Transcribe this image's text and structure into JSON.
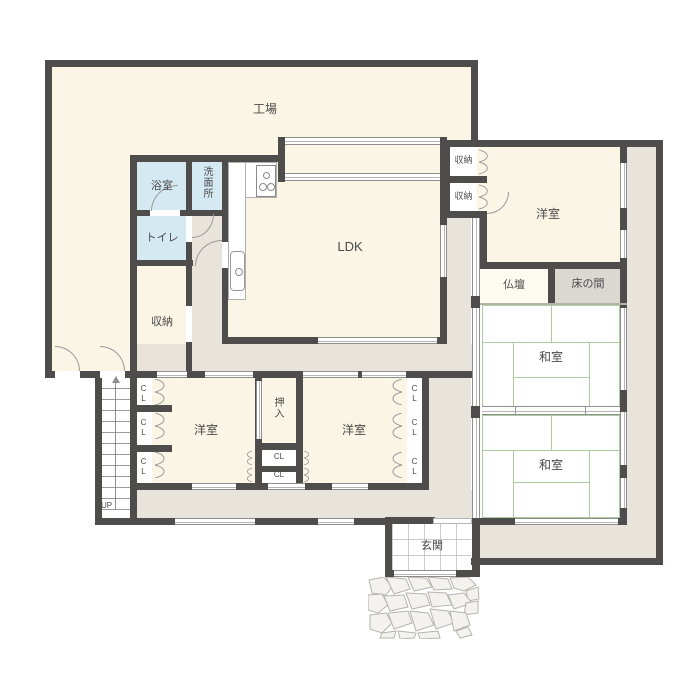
{
  "rooms": {
    "factory": {
      "label": "工場"
    },
    "bathroom": {
      "label": "浴室"
    },
    "washroom": {
      "label": "洗面所"
    },
    "toilet": {
      "label": "トイレ"
    },
    "storage": {
      "label": "収納"
    },
    "ldk": {
      "label": "LDK"
    },
    "western_room": {
      "label": "洋室"
    },
    "japanese_room": {
      "label": "和室"
    },
    "butsudan": {
      "label": "仏壇"
    },
    "tokonoma": {
      "label": "床の間"
    },
    "oshiire": {
      "label": "押入"
    },
    "closet": {
      "label": "CL"
    },
    "genkan": {
      "label": "玄関"
    }
  },
  "stairs": {
    "label": "UP"
  },
  "colors": {
    "wall": "#4e4d4b",
    "room-cream": "#faf5e4",
    "room-blue": "#d5e9f3",
    "corridor": "#e8e4dc",
    "tatami-green": "#a9cda1",
    "tokonoma": "#dbd7d1",
    "butsudan": "#fdfbf1",
    "frame": "#8e8e8e",
    "frame-light": "#b5b5b5",
    "door-line": "#9a9a9a",
    "ink": "#4a4a4a",
    "tile-line": "#cccccc",
    "thin-line": "#b5b2aa",
    "stone-line": "#b7b3ac",
    "stone-fill": "#f3f2ee"
  }
}
